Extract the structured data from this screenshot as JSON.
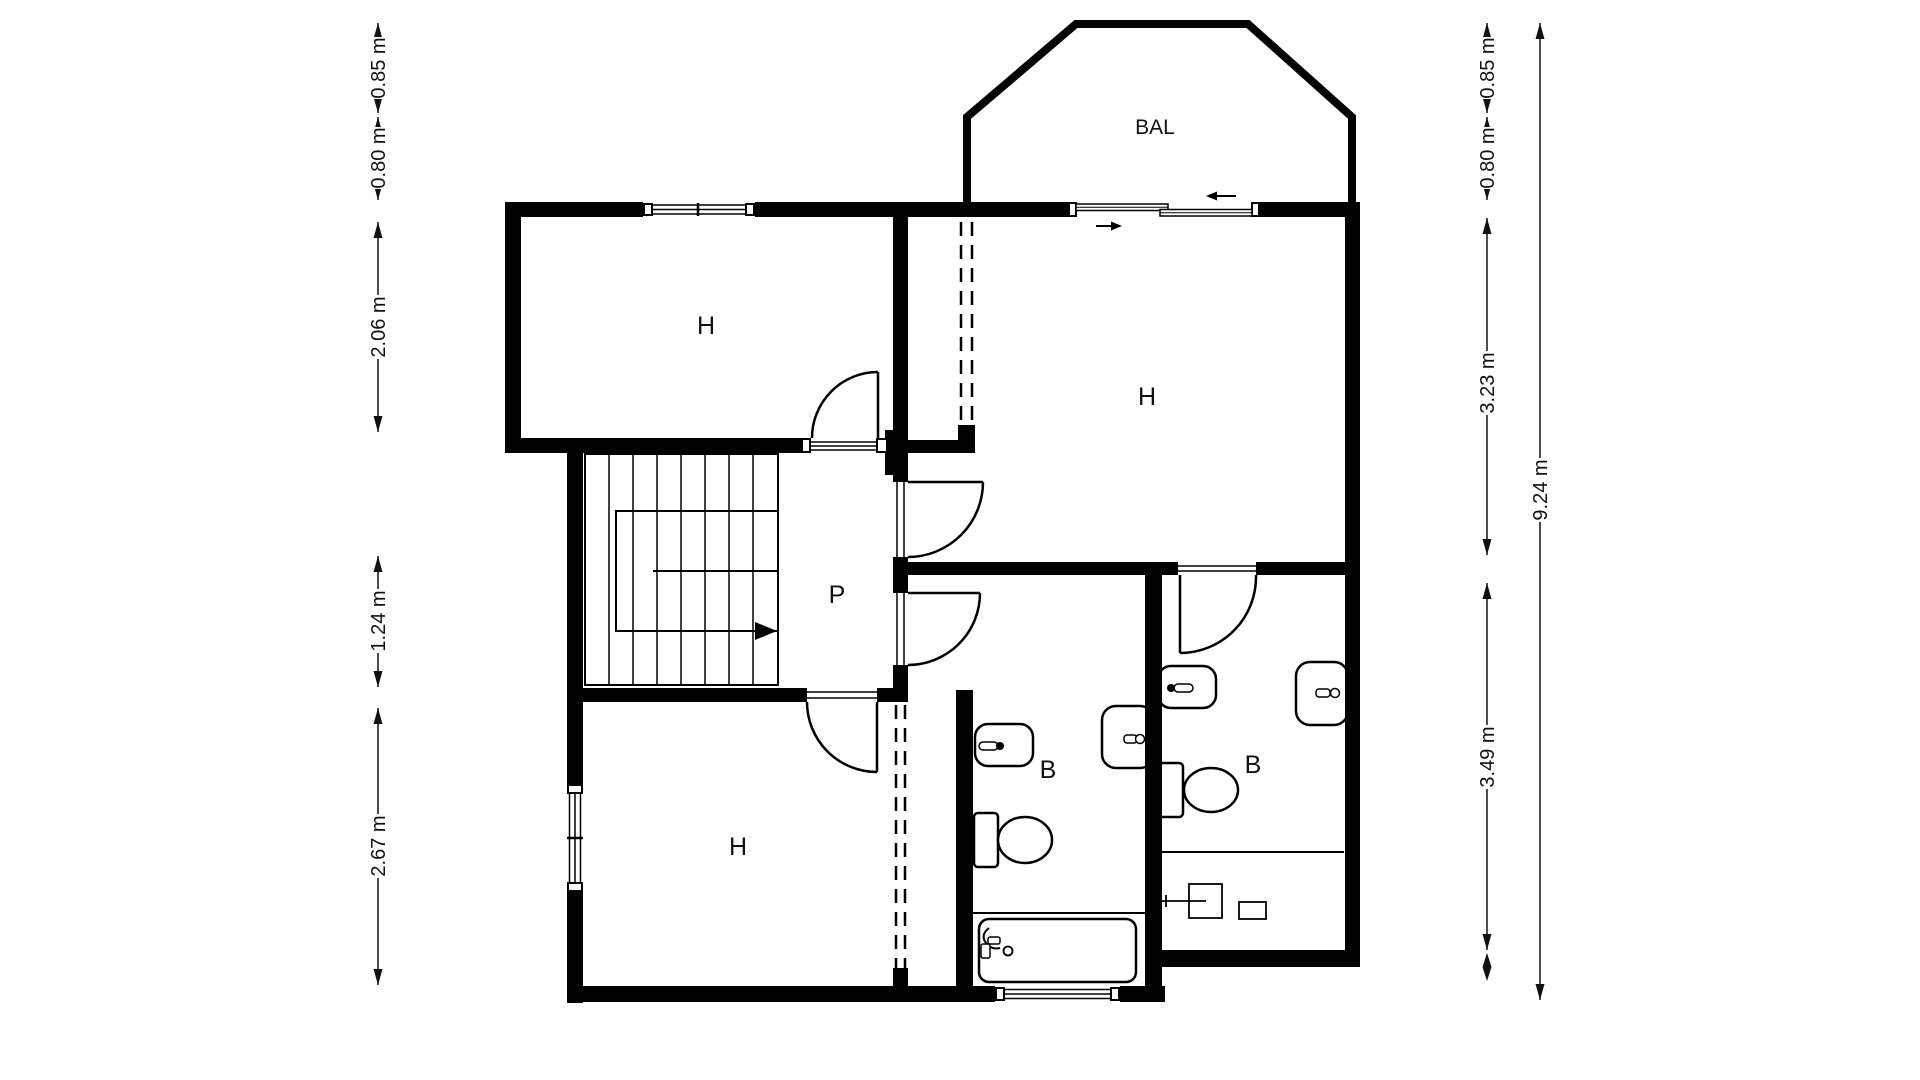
{
  "plan": {
    "colors": {
      "wall": "#000000",
      "background": "#ffffff",
      "text": "#111111"
    },
    "rooms": [
      {
        "id": "bedroom-upper-left",
        "label": "H"
      },
      {
        "id": "bedroom-upper-right",
        "label": "H"
      },
      {
        "id": "bedroom-lower-left",
        "label": "H"
      },
      {
        "id": "hallway",
        "label": "P"
      },
      {
        "id": "bathroom-middle",
        "label": "B"
      },
      {
        "id": "bathroom-right",
        "label": "B"
      },
      {
        "id": "balcony",
        "label": "BAL"
      }
    ],
    "dimensions": {
      "left": [
        {
          "label": "0.85 m"
        },
        {
          "label": "0.80 m"
        },
        {
          "label": "2.06 m"
        },
        {
          "label": "1.24 m"
        },
        {
          "label": "2.67 m"
        }
      ],
      "right": [
        {
          "label": "0.85 m"
        },
        {
          "label": "0.80 m"
        },
        {
          "label": "3.23 m"
        },
        {
          "label": "3.49 m"
        }
      ],
      "total": {
        "label": "9.24 m"
      }
    }
  }
}
